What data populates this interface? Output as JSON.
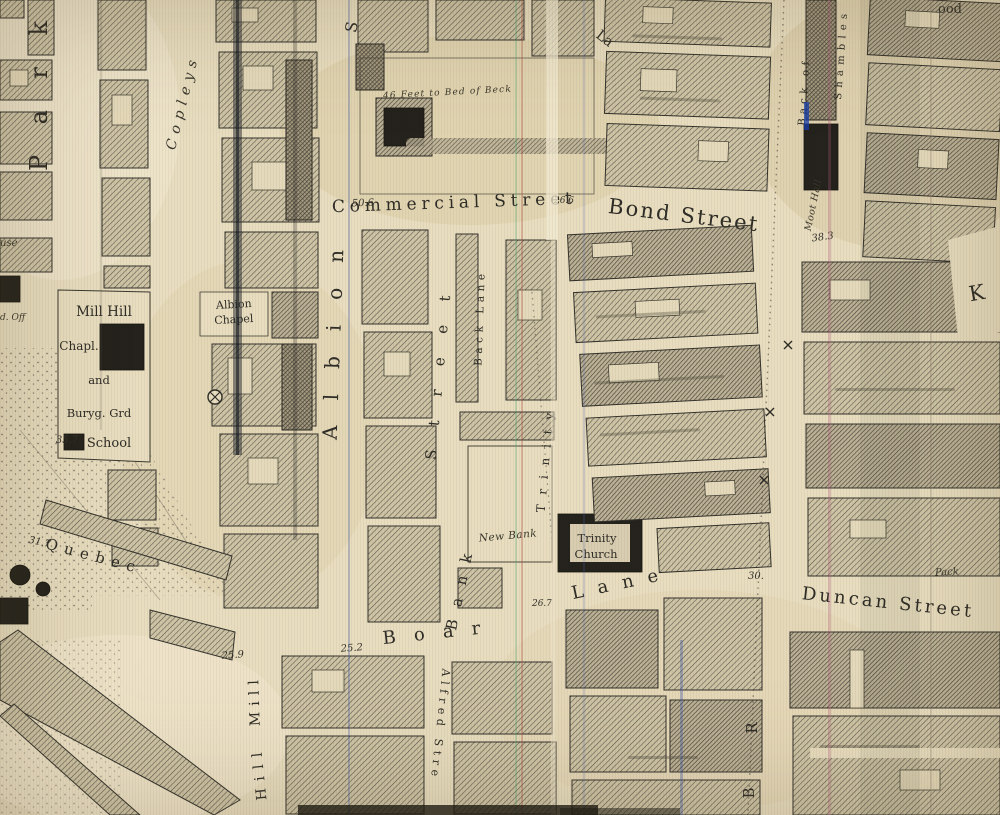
{
  "labels": {
    "park": "Park",
    "copleys": "Copleys",
    "commercial_street": "Commercial Street",
    "bond_street": "Bond Street",
    "albion": "Albion",
    "albion_s": "S",
    "bank": "Bank",
    "street": "Street",
    "back_lane": "Back Lane",
    "trinity_street": "Trinity",
    "lane_fragment": "La",
    "boar": "Boar",
    "boar_lane": "Lane",
    "duncan_street": "Duncan Street",
    "mill": "Mill",
    "hill": "Hill",
    "alfred_street": "Alfred Stre",
    "quebec": "Quebec",
    "mill_hill_chapel": {
      "l1": "Mill Hill",
      "l2": "Chapl.",
      "l3": "and",
      "l4": "Buryg. Grd",
      "l5": "School"
    },
    "albion_chapel": {
      "l1": "Albion",
      "l2": "Chapel"
    },
    "trinity_church": {
      "l1": "Trinity",
      "l2": "Church"
    },
    "new_bank": "New Bank",
    "moot_hall": "Moot Hall",
    "back_of": "Back of",
    "shambles": "Shambles",
    "beck_note": "46 Feet to Bed of Beck",
    "kirkgate_fragment": "K",
    "wood_fragment": "ood",
    "briggate_r": "R",
    "briggate_b": "B",
    "pack_fragment": "Pack",
    "house_fragment": "ouse",
    "office_fragment": "d. Off"
  },
  "numbers": {
    "n50_6": "50.6",
    "n26_6": "26.6",
    "n38_3": "38.3",
    "n35_7": "35.7",
    "n31_7": "31.7",
    "n25_9": "25.9",
    "n25_2": "25.2",
    "n26_7": "26.7",
    "n30": "30."
  },
  "colors": {
    "paper": "#e8ddbf",
    "ink": "#2e2c26",
    "hatch": "#57534a",
    "block_fill": "#cfc5a6",
    "scan_blue": "#3a57a8",
    "scan_pink": "#b05a7a"
  }
}
